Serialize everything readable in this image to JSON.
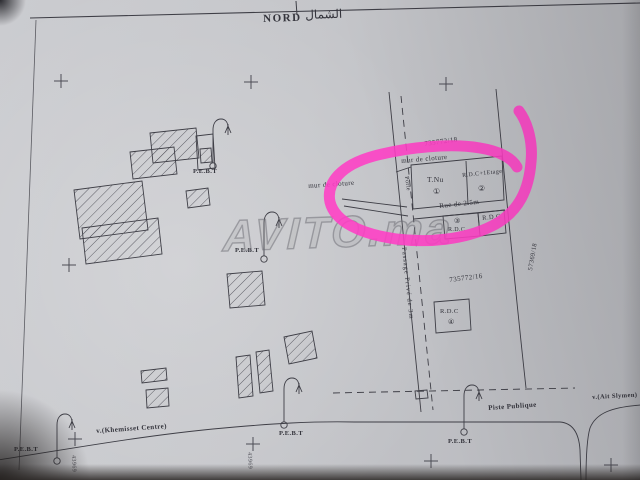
{
  "title": {
    "latin": "NORD",
    "arabic": "الشمال"
  },
  "watermark": {
    "text": "AVITO.ma"
  },
  "marker": {
    "color": "#ff3ec5"
  },
  "labels": {
    "pebt": "P.E.B.T",
    "parcel_upper": "735772/18",
    "parcel_lower": "735772/16",
    "parcel_right": "57369/18",
    "mur_cloture": "mur de cloture",
    "tnu": "T.Nu",
    "n1": "①",
    "rdc_plus_etage": "R.D.C+1Etage",
    "n2": "②",
    "porte": "Porte",
    "rue": "Rue de 2.5m",
    "n3": "③",
    "rdc": "R.D.C",
    "n4": "④",
    "passage": "Passage Privé de 3m",
    "khemisset": "v.(Khemisset Centre)",
    "ait_slymen": "v.(Ait Slymen)",
    "piste": "Piste Publique",
    "ref_left": "43969",
    "ref_center": "43969"
  }
}
